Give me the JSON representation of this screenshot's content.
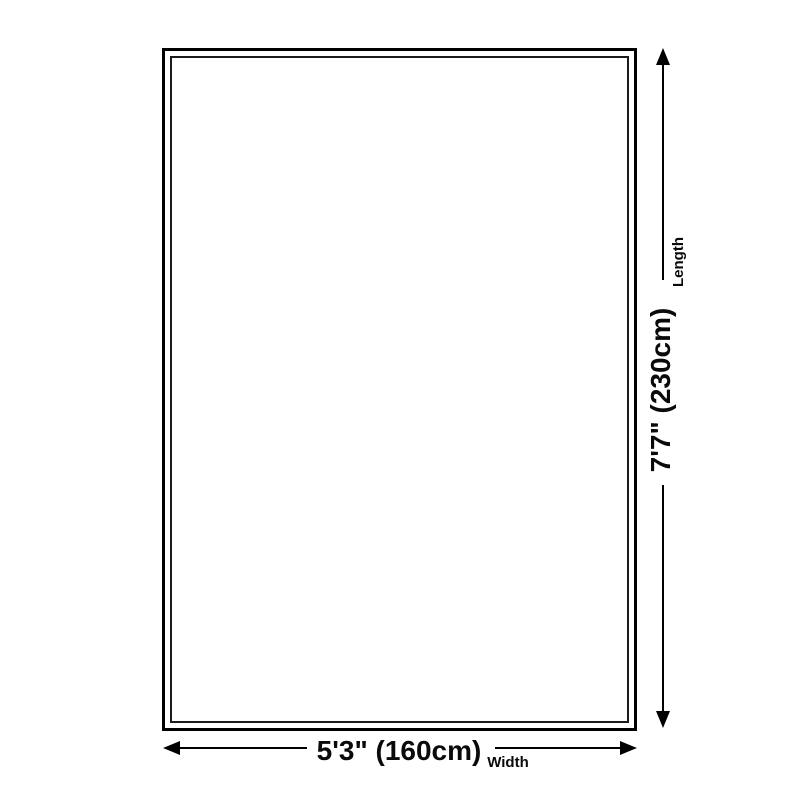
{
  "diagram": {
    "kind": "product-dimension-diagram",
    "background_color": "#ffffff",
    "outline_color": "#000000",
    "text_color": "#0a0a0a",
    "dimensions": {
      "length": {
        "value": "7'7\" (230cm)",
        "label": "Length"
      },
      "width": {
        "value": "5'3\" (160cm)",
        "label": "Width"
      }
    }
  }
}
